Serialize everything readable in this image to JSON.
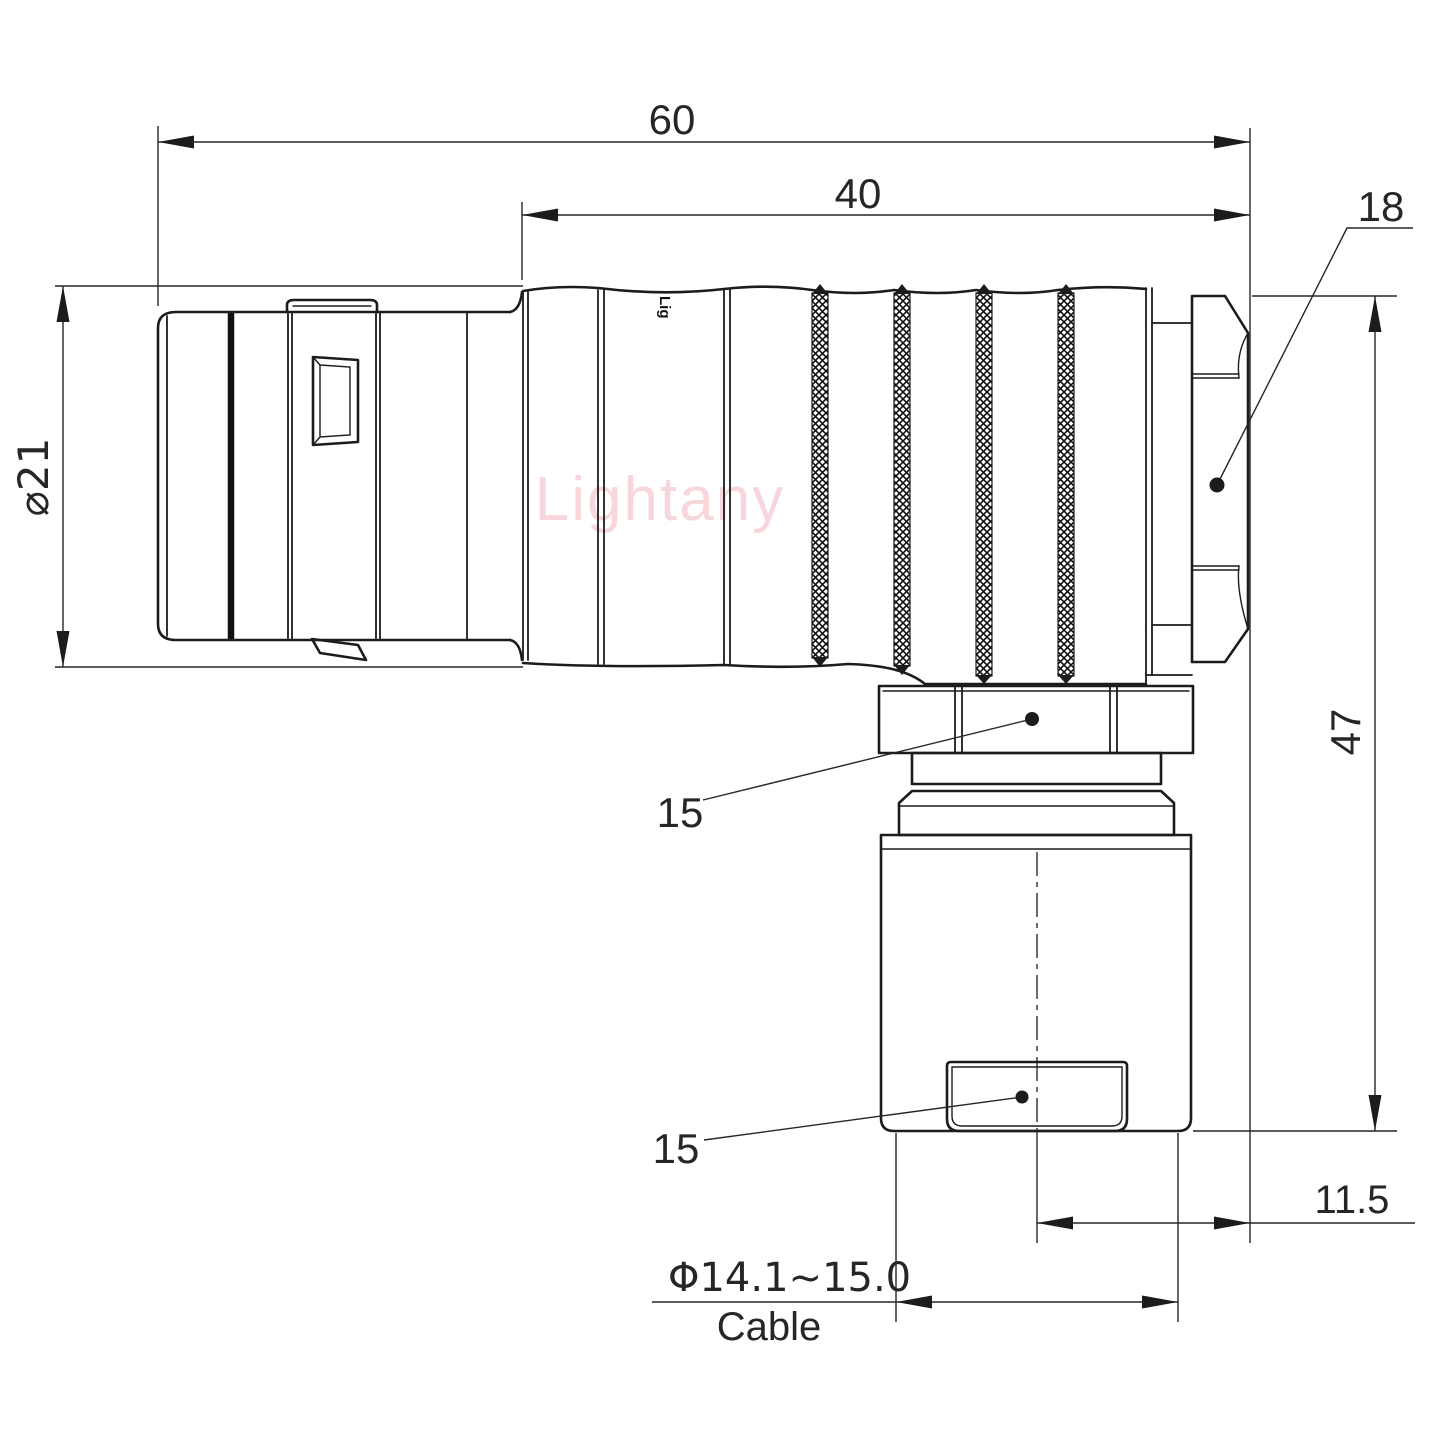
{
  "drawing": {
    "type": "engineering drawing, right-angle circular push-pull connector plug, side view",
    "watermark": "Lightany",
    "body_logo": "Lig",
    "dims": {
      "overall_length": "60",
      "body_length": "40",
      "rear_nut_size": "18",
      "front_diameter": "⌀21",
      "overall_height": "47",
      "elbow_nut_size": "15",
      "clamp_nut_size": "15",
      "axis_offset": "11.5",
      "cable_diameter": "Φ14.1~15.0",
      "cable_word": "Cable"
    },
    "colors": {
      "line": "#1c1c1c",
      "text": "#262626",
      "watermark": "#f2b8bf",
      "background": "#ffffff"
    }
  }
}
